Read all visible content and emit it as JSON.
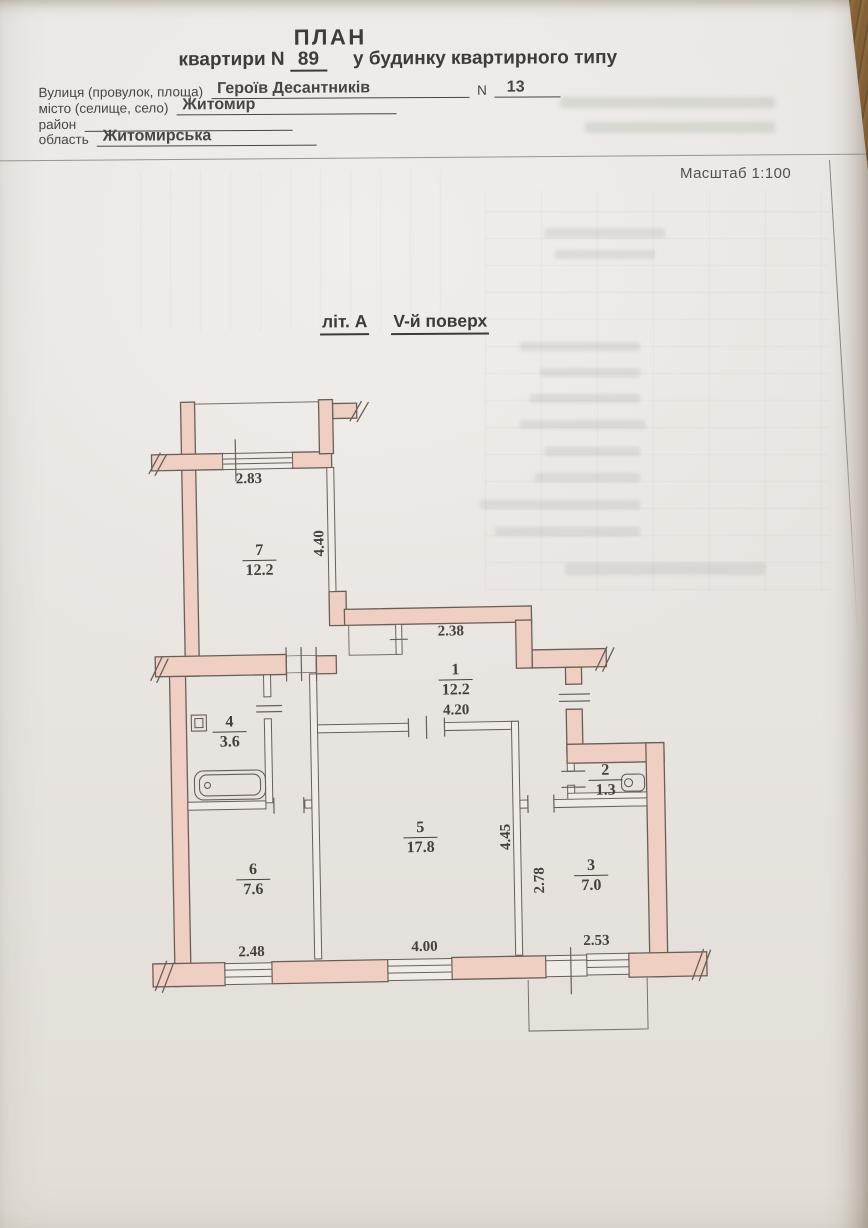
{
  "document": {
    "title": "ПЛАН",
    "subtitle_prefix": "квартири  N",
    "apartment_number": "89",
    "subtitle_suffix": "у будинку квартирного типу",
    "fields": {
      "street_label": "Вулиця (провулок, площа)",
      "street_value": "Героїв Десантників",
      "house_label": "N",
      "house_number": "13",
      "city_label": "місто (селище, село)",
      "city_value": "Житомир",
      "district_label": "район",
      "district_value": "",
      "region_label": "область",
      "region_value": "Житомирська"
    },
    "scale_label": "Масштаб 1:100"
  },
  "plan": {
    "building_letter": "літ. А",
    "floor_label": "V-й поверх",
    "rooms": [
      {
        "number": "1",
        "area": "12.2"
      },
      {
        "number": "2",
        "area": "1.3"
      },
      {
        "number": "3",
        "area": "7.0"
      },
      {
        "number": "4",
        "area": "3.6"
      },
      {
        "number": "5",
        "area": "17.8"
      },
      {
        "number": "6",
        "area": "7.6"
      },
      {
        "number": "7",
        "area": "12.2"
      }
    ],
    "dimensions": {
      "d2_83": "2.83",
      "d4_40": "4.40",
      "d2_38": "2.38",
      "d4_20": "4.20",
      "d4_45": "4.45",
      "d2_78": "2.78",
      "d4_00": "4.00",
      "d2_48": "2.48",
      "d2_53": "2.53"
    }
  },
  "colors": {
    "wall_fill": "#eecfc2",
    "wall_stroke": "#6a5f57",
    "paper": "#e9e6e2",
    "ink": "#45403a",
    "desk_wood": "#7a5530"
  }
}
